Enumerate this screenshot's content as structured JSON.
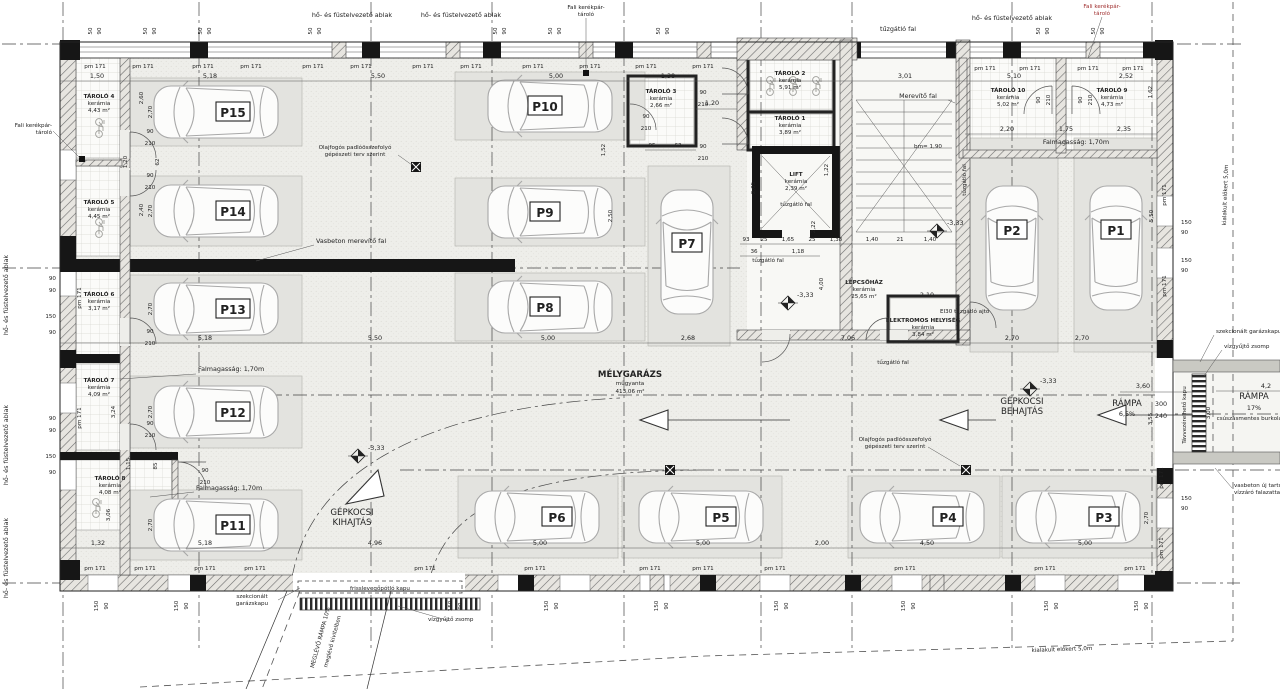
{
  "colors": {
    "accent_red": "#a03030",
    "wall_black": "#161616",
    "floor": "#eeeeea",
    "bay_fill": "#e3e3df",
    "line": "#333333"
  },
  "park": {
    "p1": "P1",
    "p2": "P2",
    "p3": "P3",
    "p4": "P4",
    "p5": "P5",
    "p6": "P6",
    "p7": "P7",
    "p8": "P8",
    "p9": "P9",
    "p10": "P10",
    "p11": "P11",
    "p12": "P12",
    "p13": "P13",
    "p14": "P14",
    "p15": "P15"
  },
  "rooms": {
    "t1": {
      "n": "TÁROLÓ 1",
      "m": "kerámia",
      "a": "3,89 m²"
    },
    "t2": {
      "n": "TÁROLÓ 2",
      "m": "kerámia",
      "a": "5,91 m²"
    },
    "t3": {
      "n": "TÁROLÓ 3",
      "m": "kerámia",
      "a": "2,66 m²"
    },
    "t4": {
      "n": "TÁROLÓ 4",
      "m": "kerámia",
      "a": "4,43 m²"
    },
    "t5": {
      "n": "TÁROLÓ 5",
      "m": "kerámia",
      "a": "4,45 m²"
    },
    "t6": {
      "n": "TÁROLÓ 6",
      "m": "kerámia",
      "a": "3,17 m²"
    },
    "t7": {
      "n": "TÁROLÓ 7",
      "m": "kerámia",
      "a": "4,09 m²"
    },
    "t8": {
      "n": "TÁROLÓ 8",
      "m": "kerámia",
      "a": "4,08 m²"
    },
    "t9": {
      "n": "TÁROLÓ 9",
      "m": "kerámia",
      "a": "4,73 m²"
    },
    "t10": {
      "n": "TÁROLÓ 10",
      "m": "kerámia",
      "a": "5,02 m²"
    },
    "lift": {
      "n": "LIFT",
      "m": "kerámia",
      "a": "2,39 m²"
    },
    "stair": {
      "n": "LÉPCSŐHÁZ",
      "m": "kerámia",
      "a": "25,65 m²"
    },
    "el": {
      "n": "ELEKTROMOS HELYISÉG",
      "m": "kerámia",
      "a": "3,84 m²"
    },
    "gar": {
      "n": "MÉLYGARÁZS",
      "m": "műgyanta",
      "a": "413,06 m²"
    }
  },
  "ann": {
    "smoke": "hő- és füstelvezető ablak",
    "bike1": "Fali kerékpár-",
    "bike2": "tároló",
    "fire": "tűzgátló fal",
    "merev": "Merevítő fal",
    "vb_merev": "Vasbeton merevítő fal",
    "oil1": "Olajfogós padlóösszefolyó",
    "oil2": "gépészeti terv szerint",
    "falmag": "Falmagasság: 1,70m",
    "ei30": "EI30 tűzgátló ajtó",
    "beh1": "GÉPKOCSI",
    "beh2": "BEHAJTÁS",
    "kih1": "GÉPKOCSI",
    "kih2": "KIHAJTÁS",
    "ramp": "RÁMPA",
    "r65": "6,5%",
    "r17": "17%",
    "rcs": "csúszásmentes burkolattal",
    "old1": "MEGLÉVŐ RÁMPA 10%",
    "old2": "meglévő kivitelben",
    "fresh": "frisslevegőpótló kapu",
    "szek1": "szekcionált",
    "szek2": "garázskapu",
    "szekg": "szekcionált garázskapu",
    "sump": "vízgyűjtő zsomp",
    "remote": "Távvezérelhető kapu",
    "vbuj1": "vasbeton új tartófal",
    "vbuj2": "vízzáró falazattal",
    "elokert": "kialakult előkert 5,0m",
    "lvl": "-3,33",
    "bm": "bm= 1,90"
  },
  "dims": {
    "pm": "pm 171",
    "w50": "50",
    "w90": "90",
    "w150": "150",
    "d90": "90",
    "d210": "210",
    "a115": "1,15",
    "a118": "1,18",
    "a120": "1,20",
    "a122": "1,22",
    "a132": "1,32",
    "a138": "1,38",
    "a140": "1,40",
    "a150": "1,50",
    "a152": "1,52",
    "a162": "1,62",
    "a165": "1,65",
    "a175": "1,75",
    "a200": "2,00",
    "a205": "2,05",
    "a210": "2,10",
    "a220": "2,20",
    "a222": "2,22",
    "a235": "2,35",
    "a240": "2,40",
    "a250": "2,50",
    "a252": "2,52",
    "a260": "2,60",
    "a268": "2,68",
    "a270": "2,70",
    "a300": "3,00",
    "a301": "3,01",
    "a306": "3,06",
    "a324": "3,24",
    "a355": "3,55",
    "a360": "3,60",
    "a400": "4,00",
    "a42": "4,2",
    "a450": "4,50",
    "a496": "4,96",
    "a500": "5,00",
    "a510": "5,10",
    "a518": "5,18",
    "a550": "5,50",
    "a706": "7,06",
    "n21": "21",
    "n25": "25",
    "n36": "36",
    "n62": "62",
    "n63": "63",
    "n85": "85",
    "n93": "93",
    "n95": "95",
    "g300": "300",
    "g240": "240"
  }
}
